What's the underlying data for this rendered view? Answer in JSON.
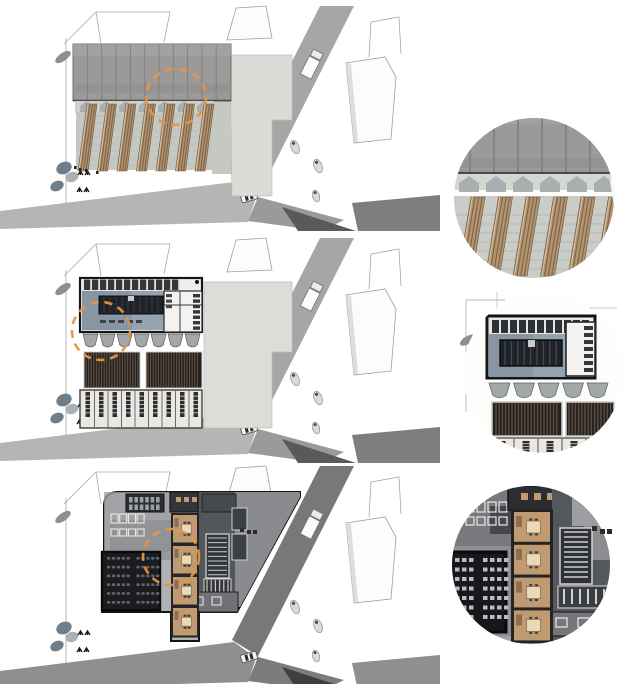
{
  "diagram": {
    "title_visible_text": "",
    "type": "architectural-site-plan-sequence",
    "panels": [
      {
        "name": "roof-massing-plan",
        "detail": "roof-and-timber-fins-detail"
      },
      {
        "name": "upper-floor-plan",
        "detail": "upper-floor-plan-detail"
      },
      {
        "name": "ground-floor-plan",
        "detail": "ground-floor-plan-detail"
      }
    ]
  },
  "colors": {
    "background": "#ffffff",
    "highlight_orange": "#e8953f",
    "roof_gray": "#9b9a98",
    "wood": "#b2946f",
    "wood_stripe": "#7c634c",
    "plan_wash_blue": "#94a3b0",
    "hatch_dark": "#262120",
    "tan_room": "#c09b72",
    "auditorium": "#1b1c1f",
    "road_schemes": {
      "light": {
        "main": "#a6a6a4",
        "wedge": "#b5b5b3",
        "branch": "#9a9a98",
        "dark": "#595957",
        "corner": "#7e7e7c"
      },
      "dark": {
        "main": "#787876",
        "wedge": "#8f8f8d",
        "branch": "#7c7c7a",
        "dark": "#3f3f3d",
        "corner": "#8f8f8d"
      }
    }
  },
  "context_rows": [
    {
      "use": "ctx-row-1",
      "scheme": "light"
    },
    {
      "use": "ctx-row-2",
      "scheme": "light"
    },
    {
      "use": "ctx-row-3",
      "scheme": "dark"
    }
  ],
  "highlights": [
    {
      "cx": 176,
      "cy": 97,
      "r": 29
    },
    {
      "cx": 101,
      "cy": 331,
      "r": 29
    },
    {
      "cx": 171,
      "cy": 557,
      "r": 28
    }
  ],
  "repeats": [
    {
      "target": "roof-seams",
      "type": "vlines",
      "x0": 87.5,
      "step": 14.3,
      "count": 10,
      "y0": 45,
      "y1": 100,
      "stroke": "#7f7f7d",
      "sw": 0.9
    },
    {
      "target": "monitor-chevrons",
      "type": "penta",
      "x0": 80,
      "y": 101,
      "step": 19.5,
      "count": 7,
      "w": 13,
      "h": 11,
      "fill": "#a9aeb0"
    },
    {
      "target": "fin-grid-lines",
      "type": "hlines",
      "y0": 116,
      "step": 7,
      "count": 8,
      "x0": 77,
      "x1": 213,
      "stroke": "#b2b6b1",
      "sw": 0.6
    },
    {
      "target": "wood-fins",
      "type": "fins",
      "x0": 78,
      "step": 19.5,
      "count": 7,
      "w": 10,
      "yT": 104,
      "yB": 171,
      "lean": 9,
      "fill": "#b2946f",
      "stripe": "#7c634c",
      "edge": "#d8c4a4"
    },
    {
      "target": "d1-roof-seams",
      "type": "vlines",
      "x0": 470,
      "step": 24,
      "count": 7,
      "y0": 112,
      "y1": 172,
      "stroke": "#7c7c7a",
      "sw": 1.5
    },
    {
      "target": "d1-chevrons",
      "type": "penta",
      "x0": 459,
      "y": 176,
      "step": 27,
      "count": 6,
      "w": 20,
      "h": 16,
      "fill": "#a9aeb0"
    },
    {
      "target": "d1-grid",
      "type": "hlines",
      "y0": 215,
      "step": 9,
      "count": 7,
      "x0": 454,
      "x1": 616,
      "stroke": "#afb3ae",
      "sw": 0.8
    },
    {
      "target": "d1-fins",
      "type": "fins",
      "x0": 458,
      "step": 27.5,
      "count": 6,
      "w": 14,
      "yT": 197,
      "yB": 276,
      "lean": 13,
      "fill": "#b2946f",
      "stripe": "#7c634c",
      "edge": "#d8c4a4"
    },
    {
      "target": "u-cells",
      "type": "rowrects",
      "x0": 84,
      "y0": 279.5,
      "step": 8,
      "count": 12,
      "w": 6.2,
      "h": 10.5,
      "fill": "#34383c"
    },
    {
      "target": "u-table-stripes",
      "type": "vlines",
      "x0": 104,
      "step": 6,
      "count": 10,
      "y0": 297,
      "y1": 313,
      "stroke": "#3a3f45",
      "sw": 1
    },
    {
      "target": "u-desk-bars",
      "type": "rowrects",
      "x0": 100,
      "y0": 320,
      "step": 9,
      "count": 5,
      "w": 6,
      "h": 3,
      "fill": "#3c4246"
    },
    {
      "target": "u-right-bars",
      "type": "colrects",
      "x0": 193,
      "y0": 294,
      "step": 5.4,
      "count": 7,
      "w": 7,
      "h": 3.4,
      "fill": "#34383c"
    },
    {
      "target": "u-right-bars2",
      "type": "colrects",
      "x0": 166,
      "y0": 294,
      "step": 5.5,
      "count": 3,
      "w": 6,
      "h": 3.2,
      "fill": "#44484c"
    },
    {
      "target": "u-scallops",
      "type": "scallops",
      "x0": 83,
      "y": 334,
      "step": 17,
      "count": 7,
      "w": 15,
      "h": 15,
      "fill": "#a2a7aa",
      "stroke": "#5c5c5a"
    },
    {
      "target": "u-hatchA",
      "type": "vlines",
      "x0": 86,
      "step": 2.6,
      "count": 21,
      "y0": 353,
      "y1": 387,
      "stroke": "#5e5040",
      "sw": 1.1
    },
    {
      "target": "u-hatchB",
      "type": "vlines",
      "x0": 148,
      "step": 2.6,
      "count": 20,
      "y0": 353,
      "y1": 387,
      "stroke": "#5e5040",
      "sw": 1.1
    },
    {
      "target": "u-shelves",
      "type": "shelves",
      "x0": 81,
      "step": 13.5,
      "count": 9,
      "y0": 390,
      "y1": 427,
      "wallStroke": "#6b6b69",
      "wallW": 1,
      "shelfW": 4.5,
      "shelfH": 25,
      "shelfFill": "#2e2e2e",
      "rungs": 5,
      "rungStroke": "#dcdcda"
    },
    {
      "target": "d2-cells",
      "type": "rowrects",
      "x0": 492,
      "y0": 320,
      "step": 9,
      "count": 11,
      "w": 7,
      "h": 13,
      "fill": "#2e3236"
    },
    {
      "target": "d2-stripes",
      "type": "vlines",
      "x0": 505,
      "step": 6.4,
      "count": 9,
      "y0": 341,
      "y1": 365,
      "stroke": "#42474d",
      "sw": 1.4
    },
    {
      "target": "d2-right-bars",
      "type": "colrects",
      "x0": 584,
      "y0": 326,
      "step": 7,
      "count": 7,
      "w": 9,
      "h": 4,
      "fill": "#34383c"
    },
    {
      "target": "d2-scallops",
      "type": "scallops",
      "x0": 489,
      "y": 383,
      "step": 24.5,
      "count": 5,
      "w": 21,
      "h": 17,
      "fill": "#a2a7aa",
      "stroke": "#5c5c5a"
    },
    {
      "target": "d2-hA",
      "type": "vlines",
      "x0": 496,
      "step": 3.2,
      "count": 20,
      "y0": 403,
      "y1": 435,
      "stroke": "#5e5040",
      "sw": 1.3
    },
    {
      "target": "d2-hB",
      "type": "vlines",
      "x0": 569,
      "step": 3.2,
      "count": 14,
      "y0": 403,
      "y1": 435,
      "stroke": "#5e5040",
      "sw": 1.3
    },
    {
      "target": "d2-shelves",
      "type": "shelves",
      "x0": 490,
      "step": 24,
      "count": 5,
      "y0": 439,
      "y1": 453,
      "wallStroke": "#6b6b69",
      "wallW": 1.2,
      "shelfW": 7,
      "shelfH": 11,
      "shelfFill": "#2e2e2e",
      "rungs": 3,
      "rungStroke": "#dcdcda"
    },
    {
      "target": "g-lockers",
      "type": "grid",
      "x0": 129,
      "y0": 497,
      "cols": 6,
      "rows": 2,
      "cw": 3.6,
      "ch": 5.5,
      "gx": 5.4,
      "gy": 7.5,
      "fill": "#9aa0a4"
    },
    {
      "target": "g-dots",
      "type": "rowrects",
      "x0": 176,
      "y0": 497,
      "step": 8,
      "count": 3,
      "w": 5,
      "h": 5,
      "fill": "#c09b72"
    },
    {
      "target": "g-furnA",
      "type": "rowrects",
      "x0": 111,
      "y0": 514,
      "step": 8.7,
      "count": 4,
      "w": 7,
      "h": 9,
      "stroke": "#f0f0ee",
      "sw": 1
    },
    {
      "target": "g-furnB",
      "type": "rowrects",
      "x0": 111,
      "y0": 529,
      "step": 8.7,
      "count": 4,
      "w": 7,
      "h": 7,
      "stroke": "#f0f0ee",
      "sw": 1
    },
    {
      "target": "g-seats",
      "type": "grid",
      "x0": 107,
      "y0": 557,
      "cols": 10,
      "rows": 6,
      "cw": 3.2,
      "ch": 2.6,
      "gx": 4.9,
      "gy": 8.8,
      "gapAfter": 5,
      "gapW": 5,
      "fill": "#62666c"
    },
    {
      "target": "g-stair1",
      "type": "hlines",
      "y0": 538,
      "step": 4.6,
      "count": 9,
      "x0": 208,
      "x1": 227,
      "stroke": "#c9c9c7",
      "sw": 1
    },
    {
      "target": "g-stair2",
      "type": "vlines",
      "x0": 207,
      "step": 4.2,
      "count": 6,
      "y0": 580,
      "y1": 592,
      "stroke": "#c9c9c7",
      "sw": 1.2
    },
    {
      "target": "g-rooms",
      "type": "rooms",
      "x": 173,
      "y0": 515,
      "count": 4,
      "w": 24,
      "h": 27.5,
      "gap": 3.5,
      "wall": "#262626",
      "wallT": 2,
      "fill": "#c09b72",
      "closet": [
        1.5,
        3,
        4,
        9,
        "#8a6f52"
      ],
      "table": [
        10,
        9,
        "#ead9b8"
      ],
      "chair": "#3c3c3c"
    },
    {
      "target": "d3-dots",
      "type": "rowrects",
      "x0": 521,
      "y0": 493,
      "step": 13,
      "count": 3,
      "w": 7,
      "h": 7,
      "fill": "#c09b72"
    },
    {
      "target": "d3-furnA",
      "type": "rowrects",
      "x0": 466,
      "y0": 502,
      "step": 11,
      "count": 4,
      "w": 8,
      "h": 10,
      "stroke": "#eceae8",
      "sw": 1.2
    },
    {
      "target": "d3-furnB",
      "type": "rowrects",
      "x0": 466,
      "y0": 517,
      "step": 11,
      "count": 4,
      "w": 8,
      "h": 8,
      "stroke": "#eceae8",
      "sw": 1.2
    },
    {
      "target": "d3-seats",
      "type": "grid",
      "x0": 455,
      "y0": 558,
      "cols": 7,
      "rows": 7,
      "cw": 4.5,
      "ch": 4,
      "gx": 7,
      "gy": 9.5,
      "gapAfter": 3,
      "gapW": 7,
      "fill": "#b9bcc0"
    },
    {
      "target": "d3-stair1",
      "type": "hlines",
      "y0": 532,
      "step": 5,
      "count": 10,
      "x0": 564,
      "x1": 588,
      "stroke": "#d0d0ce",
      "sw": 1.4
    },
    {
      "target": "d3-stair2",
      "type": "vlines",
      "x0": 564,
      "step": 8,
      "count": 6,
      "y0": 589,
      "y1": 604,
      "stroke": "#d0d0ce",
      "sw": 2
    },
    {
      "target": "d3-rooms",
      "type": "rooms",
      "x": 514,
      "y0": 512,
      "count": 4,
      "w": 36,
      "h": 30,
      "gap": 2.8,
      "wall": "#242424",
      "wallT": 3,
      "fill": "#c09b72",
      "closet": [
        2,
        4,
        6,
        11,
        "#8a6f52"
      ],
      "table": [
        14,
        12,
        "#ead9b8"
      ],
      "chair": "#3c3c3c"
    }
  ]
}
